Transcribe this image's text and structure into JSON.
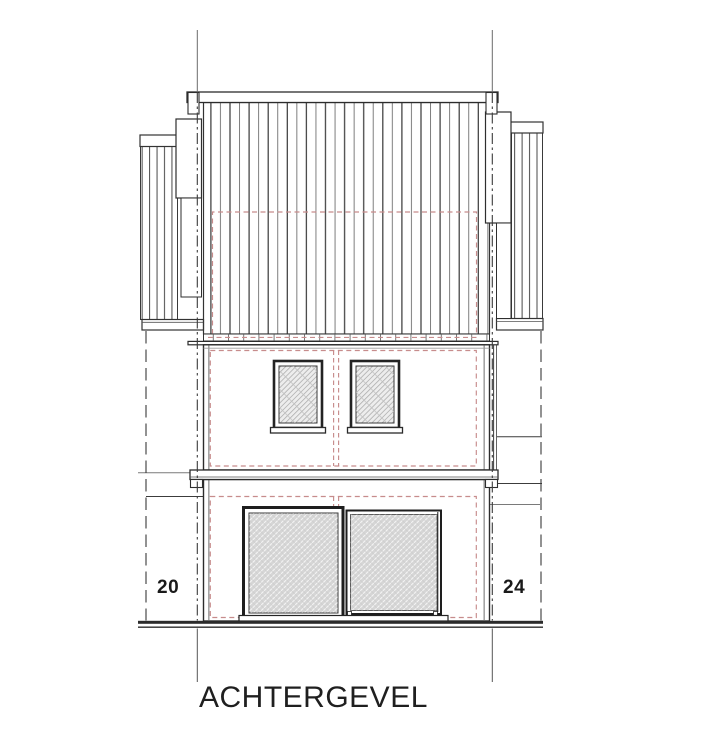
{
  "drawing": {
    "title": "ACHTERGEVEL",
    "neighbor_left_number": "20",
    "neighbor_right_number": "24"
  },
  "colors": {
    "linework": "#2f2f2f",
    "secondary_line": "#777777",
    "existing_outline_red": "#c78c8c",
    "window_glass": "#ededed",
    "door_glass": "#d6d6d6",
    "background": "#ffffff",
    "text": "#1a1a1a"
  }
}
